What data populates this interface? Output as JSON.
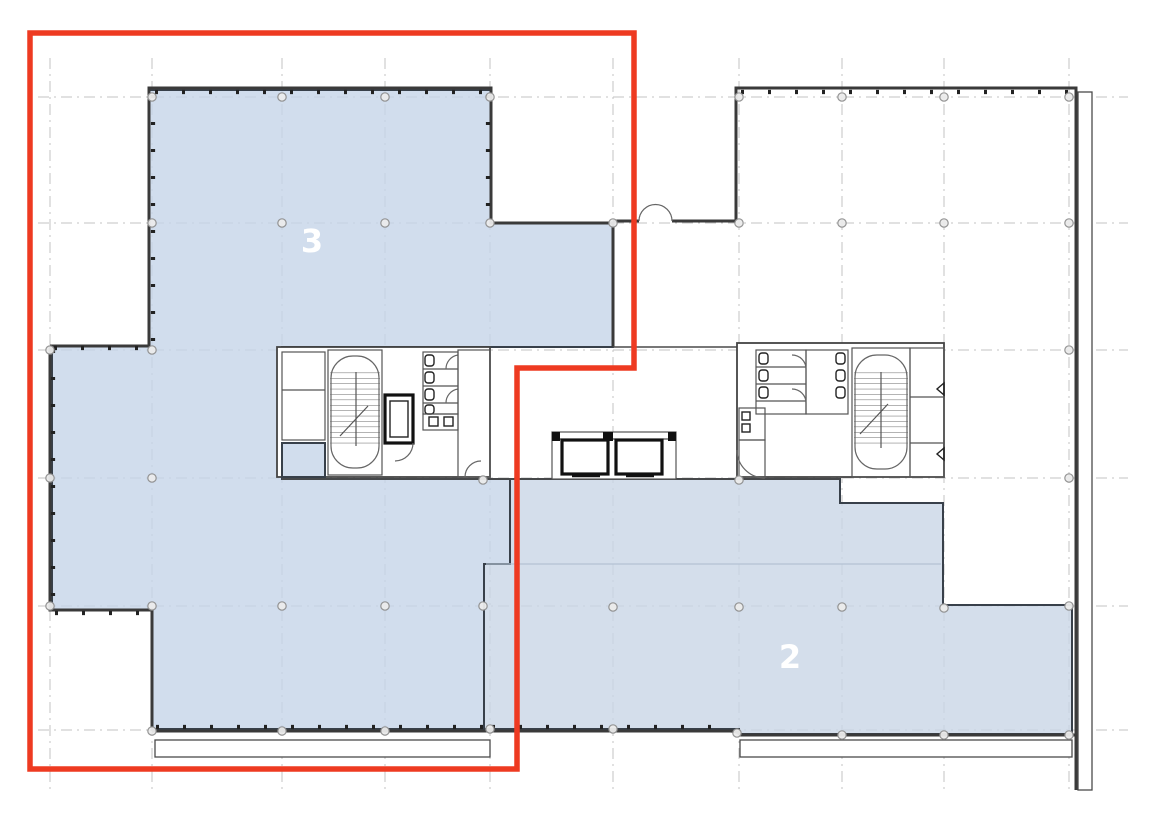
{
  "plan": {
    "title": "floor-plan",
    "zones": {
      "zone3": {
        "label": "3",
        "fill": "#c5d4e8"
      },
      "zone2": {
        "label": "2",
        "fill": "#c9d6e6"
      }
    },
    "selection": {
      "outline_color": "#ee3a21"
    }
  }
}
